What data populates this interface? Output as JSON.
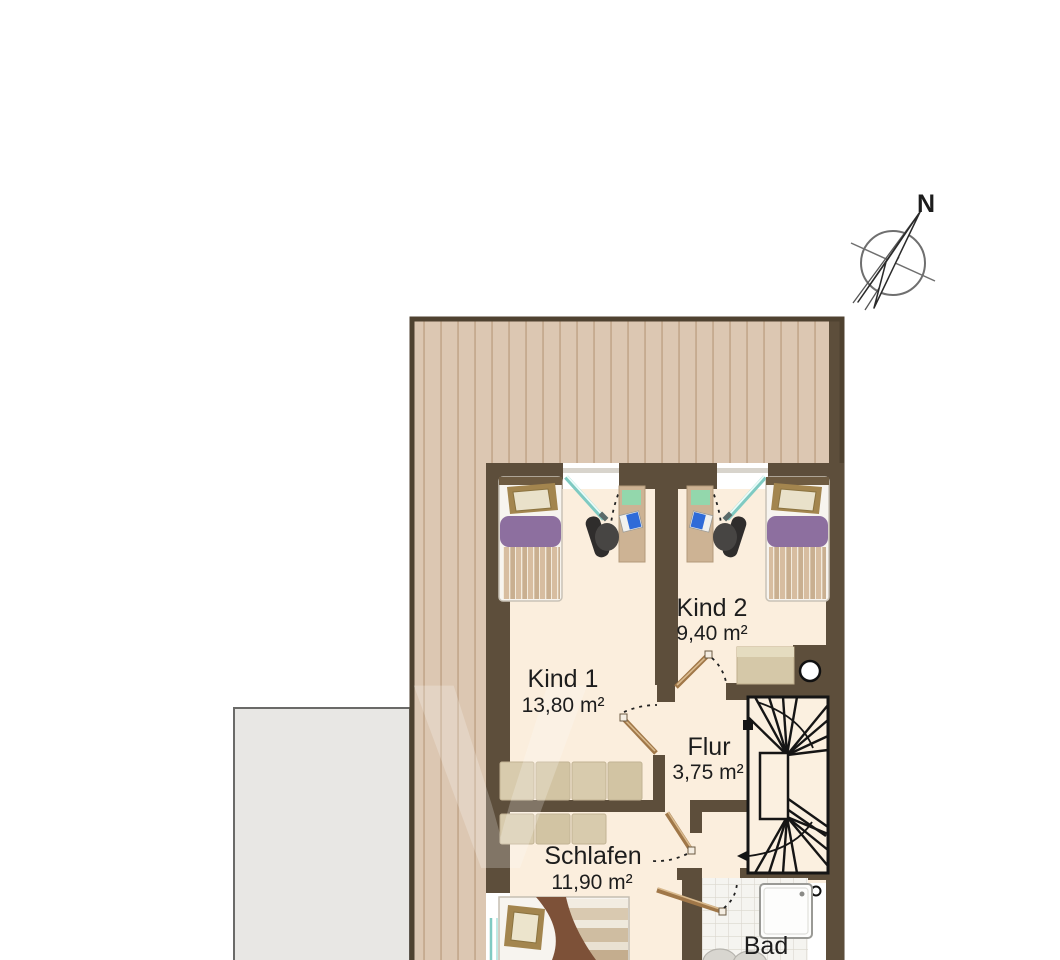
{
  "title": "Dachgeschoss Grundriss",
  "compass": {
    "north_label": "N"
  },
  "rooms": [
    {
      "name": "Kind 1",
      "area": "13,80 m²"
    },
    {
      "name": "Kind 2",
      "area": "9,40 m²"
    },
    {
      "name": "Flur",
      "area": "3,75 m²"
    },
    {
      "name": "Schlafen",
      "area": "11,90 m²"
    },
    {
      "name": "Bad",
      "area": ""
    }
  ],
  "watermark": "V",
  "colors": {
    "wall": "#5d4e3b",
    "outline": "#4f4230",
    "roof": "#dcc7b2",
    "roof_stripe": "#c3a88d",
    "floor": "#fbeedd",
    "terrace_gray": "#e8e7e4",
    "bed_purple": "#8d6f9f",
    "furniture_tan": "#d8cbad",
    "door_wood": "#a07748",
    "window_teal": "#7fcac2",
    "stair_line": "#151515",
    "desk_pad_green": "#93d7ac",
    "laptop_blue": "#2f6bd8"
  }
}
